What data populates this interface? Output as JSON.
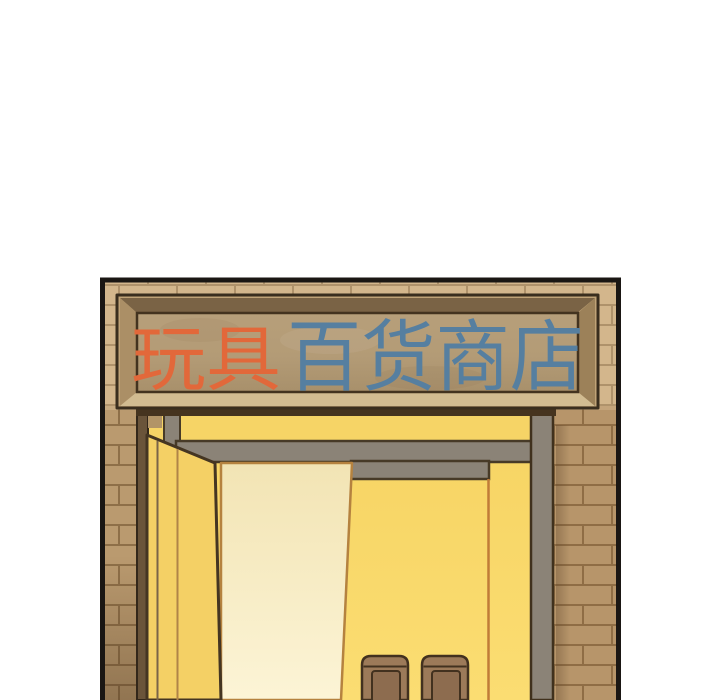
{
  "scene_title": "玩具百货商店",
  "sign": {
    "full_text": "玩具百货商店",
    "toys": {
      "text": "玩具",
      "color": "#e2683a"
    },
    "store": {
      "text": "百货商店",
      "color": "#567fa0"
    }
  },
  "colors": {
    "background": "#ffffff",
    "panel_border": "#1a1613",
    "brick_base": "#c4a478",
    "brick_mortar": "#94744c",
    "sign_frame_wood": "#c0a377",
    "sign_board": "#b39b76",
    "lintel_dark": "#46341f",
    "door_frame_yellow": "#f6d466",
    "open_door_yellow": "#f4d065",
    "interior_light": "#f8d667",
    "sliding_panel_cream": "#f9efc7",
    "rail_gray": "#8b8377",
    "hinge_wood": "#6a543a",
    "stool_brown": "#9c7a59",
    "stool_inner_brown": "#8d6c4f",
    "outline_dark": "#3b2d1b",
    "accent_orange_line": "#c07c38"
  }
}
